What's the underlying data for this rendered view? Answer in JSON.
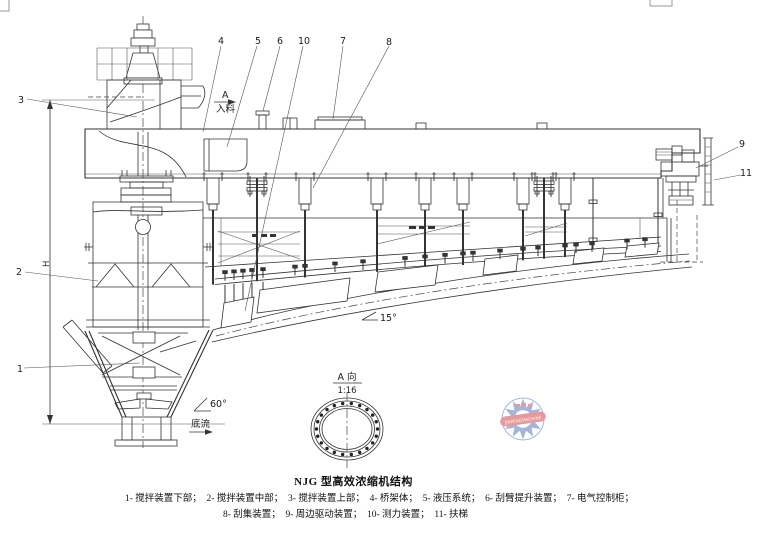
{
  "figure": {
    "title": "NJG 型高效浓缩机结构",
    "legend_line1": "1- 搅拌装置下部；　2- 搅拌装置中部；　3- 搅拌装置上部；　4- 桥架体；　5- 液压系统；　6- 刮臂提升装置；　7- 电气控制柜；",
    "legend_line2": "8- 刮集装置；　9- 周边驱动装置；　10- 测力装置；　11- 扶梯"
  },
  "part_labels": {
    "p1": "1",
    "p2": "2",
    "p3": "3",
    "p4": "4",
    "p5": "5",
    "p6": "6",
    "p7": "7",
    "p8": "8",
    "p9": "9",
    "p10": "10",
    "p11": "11"
  },
  "annotations": {
    "section_letter": "A",
    "feed": "入料",
    "underflow": "底流",
    "cone_angle": "60°",
    "floor_angle": "15°",
    "view_title": "A 向",
    "view_scale": "1:16",
    "dim_height": "H"
  },
  "watermark": {
    "band_text": "JINPENGMACHINE"
  },
  "colors": {
    "line": "#333333",
    "watermark_blue": "#4a6fb5",
    "watermark_red": "#cc3747"
  }
}
